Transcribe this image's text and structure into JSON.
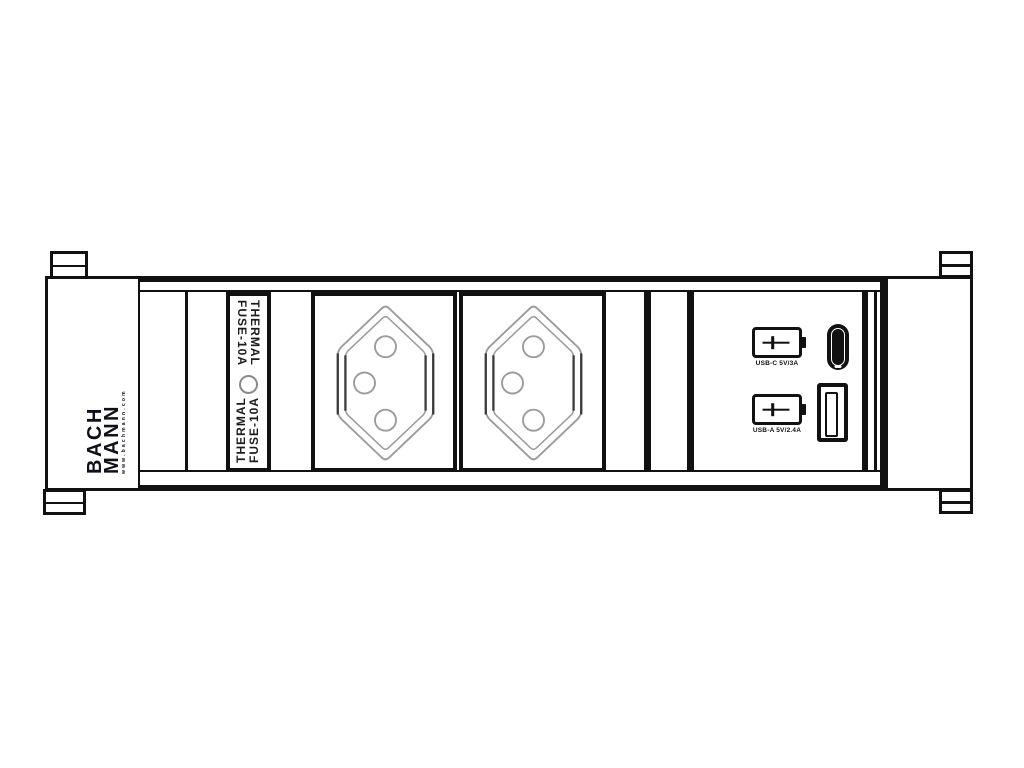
{
  "device": {
    "type": "power-strip-technical-drawing",
    "brand": {
      "line1": "BACH",
      "line2": "MANN",
      "tagline": "www.bachmann.com"
    },
    "fuse_label": {
      "line1": "THERMAL",
      "line2": "FUSE-10A"
    },
    "sockets": {
      "count": 2,
      "standard": "swiss-type-j",
      "pins_per_socket": 3
    },
    "usb_charger": {
      "top_spec": "USB-C 5V/3A",
      "bottom_spec": "USB-A 5V/2.4A"
    },
    "colors": {
      "line": "#111111",
      "light_line": "#9c9c9c",
      "background": "#ffffff"
    }
  }
}
